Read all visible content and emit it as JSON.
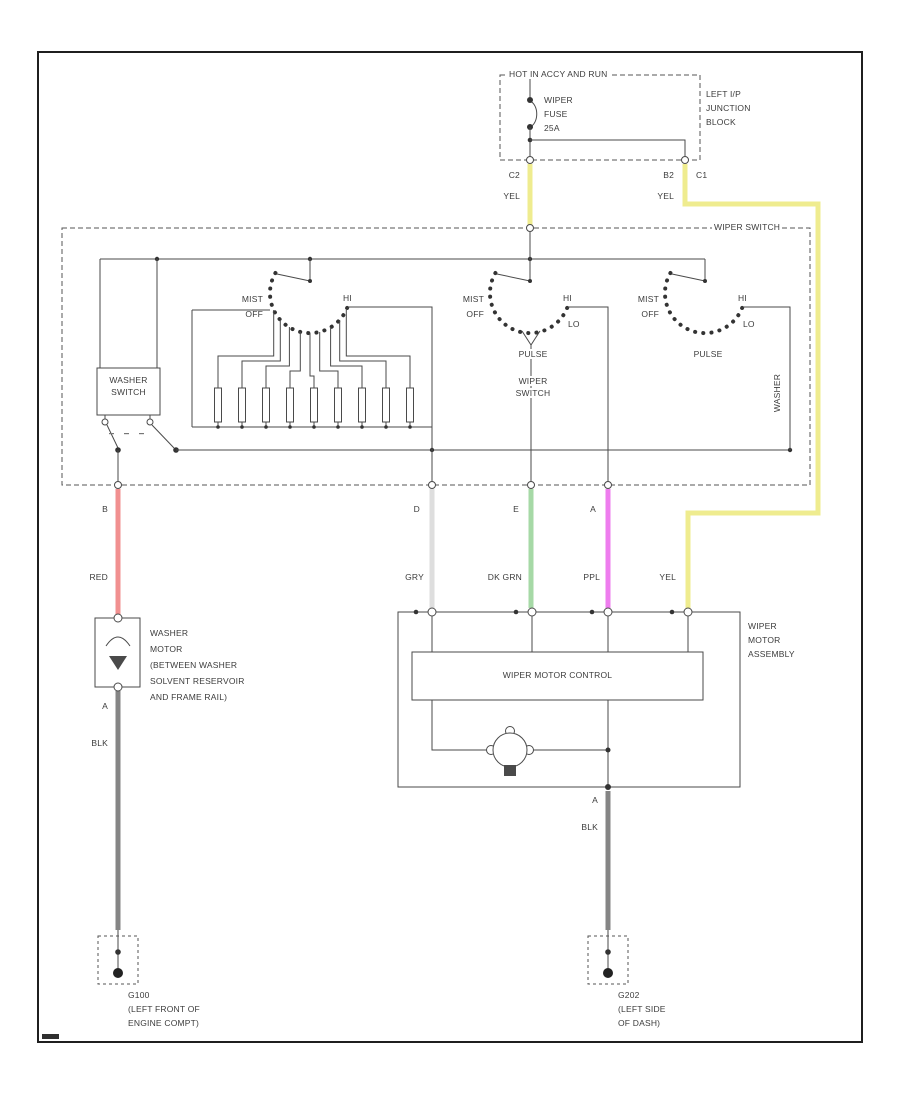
{
  "colors": {
    "yellow": "#efec8f",
    "red": "#f19090",
    "green": "#a6d9a6",
    "purple": "#ee7dee",
    "gray_wire": "#dedede",
    "black_wire": "#858585",
    "line": "#4a4a4a"
  },
  "fuse_block": {
    "hot_label": "HOT IN ACCY AND RUN",
    "fuse_line1": "WIPER",
    "fuse_line2": "FUSE",
    "fuse_line3": "25A",
    "junction_line1": "LEFT I/P",
    "junction_line2": "JUNCTION",
    "junction_line3": "BLOCK",
    "left_pin": "C2",
    "left_wire_color": "YEL",
    "right_pin": "B2",
    "right_wire_color": "YEL",
    "right_pin2": "C1"
  },
  "wiper_switch_box": {
    "label": "WIPER SWITCH",
    "washer_switch": {
      "line1": "WASHER",
      "line2": "SWITCH"
    },
    "delay": {
      "mist": "MIST",
      "off": "OFF",
      "hi": "HI"
    },
    "middle": {
      "mist": "MIST",
      "off": "OFF",
      "hi": "HI",
      "lo": "LO",
      "pulse": "PULSE",
      "caption1": "WIPER",
      "caption2": "SWITCH"
    },
    "right": {
      "mist": "MIST",
      "off": "OFF",
      "hi": "HI",
      "lo": "LO",
      "pulse": "PULSE",
      "rotated": "WASHER"
    }
  },
  "wires": {
    "red": "RED",
    "gry": "GRY",
    "dkgrn": "DK GRN",
    "ppl": "PPL",
    "yel": "YEL",
    "blk1": "BLK",
    "blk2": "BLK"
  },
  "pins": {
    "washer_in": "B",
    "washer_out": "A",
    "gry": "D",
    "dkgrn": "E",
    "ppl": "A",
    "motor_out": "A"
  },
  "washer_motor": {
    "line1": "WASHER",
    "line2": "MOTOR",
    "line3": "(BETWEEN WASHER",
    "line4": "SOLVENT RESERVOIR",
    "line5": "AND FRAME RAIL)"
  },
  "wiper_motor": {
    "line1": "WIPER",
    "line2": "MOTOR",
    "line3": "ASSEMBLY",
    "control": "WIPER MOTOR CONTROL"
  },
  "grounds": {
    "g100": "G100",
    "g100_loc1": "(LEFT FRONT OF",
    "g100_loc2": "ENGINE COMPT)",
    "g202": "G202",
    "g202_loc1": "(LEFT SIDE",
    "g202_loc2": "OF DASH)"
  }
}
